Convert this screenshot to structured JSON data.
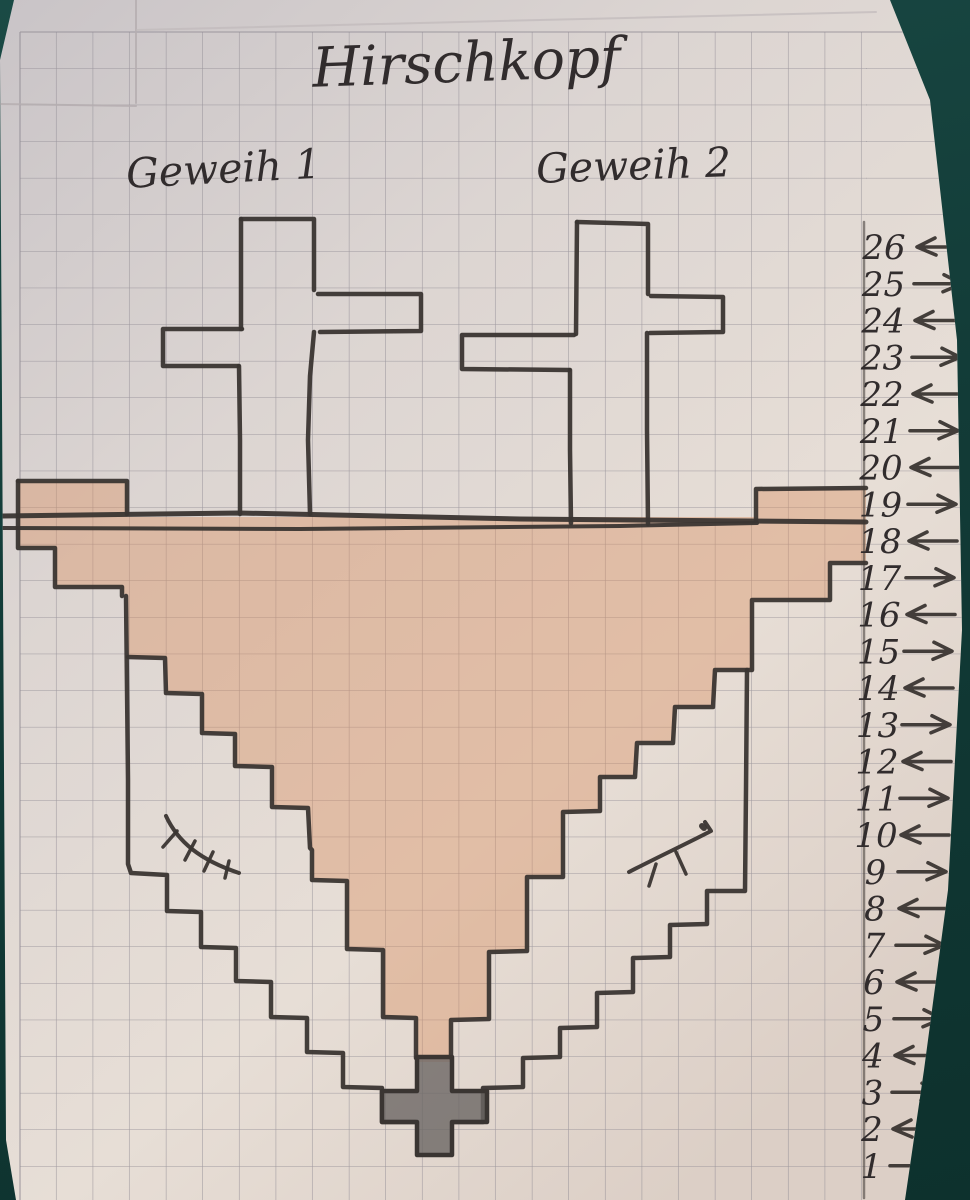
{
  "title": "Hirschkopf",
  "labels": {
    "antler1": "Geweih 1",
    "antler2": "Geweih 2"
  },
  "rows": [
    {
      "n": "26",
      "dir": "left"
    },
    {
      "n": "25",
      "dir": "right"
    },
    {
      "n": "24",
      "dir": "left"
    },
    {
      "n": "23",
      "dir": "right"
    },
    {
      "n": "22",
      "dir": "left"
    },
    {
      "n": "21",
      "dir": "right"
    },
    {
      "n": "20",
      "dir": "left"
    },
    {
      "n": "19",
      "dir": "right"
    },
    {
      "n": "18",
      "dir": "left"
    },
    {
      "n": "17",
      "dir": "right"
    },
    {
      "n": "16",
      "dir": "left"
    },
    {
      "n": "15",
      "dir": "right"
    },
    {
      "n": "14",
      "dir": "left"
    },
    {
      "n": "13",
      "dir": "right"
    },
    {
      "n": "12",
      "dir": "left"
    },
    {
      "n": "11",
      "dir": "right"
    },
    {
      "n": "10",
      "dir": "left"
    },
    {
      "n": "9",
      "dir": "right"
    },
    {
      "n": "8",
      "dir": "left"
    },
    {
      "n": "7",
      "dir": "right"
    },
    {
      "n": "6",
      "dir": "left"
    },
    {
      "n": "5",
      "dir": "right"
    },
    {
      "n": "4",
      "dir": "left"
    },
    {
      "n": "3",
      "dir": "right"
    },
    {
      "n": "2",
      "dir": "left"
    },
    {
      "n": "1",
      "dir": "right"
    }
  ],
  "colors": {
    "background": "#123b37",
    "paper_top": "#c9c4c7",
    "paper_mid": "#e2dad5",
    "paper_low": "#e7ded6",
    "paper_bottom": "#dccfc6",
    "grid": "#8f8a92",
    "pen": "#3a3532",
    "seam": "#b5aeb0",
    "head_fill": "#d98f60",
    "nose_fill": "#6b6764"
  },
  "drawing": {
    "head_fill_path": "M18,481 L127,481 L127,517 L756,517 L756,488 L866,488 L866,563 L830,563 L830,600 L752,600 L752,670 L715,670 L713,707 L675,707 L673,743 L637,743 L635,777 L600,777 L600,811 L563,812 L563,877 L527,877 L527,951 L489,952 L489,1019 L451,1020 L451,1062 L416,1062 L416,1018 L383,1017 L383,950 L347,949 L347,881 L312,880 L312,849 L308,848 L308,808 L272,807 L272,767 L235,766 L235,734 L202,733 L202,694 L166,693 L166,658 L128,657 L128,595 L122,593 L122,587 L55,587 L55,548 L18,548 Z",
    "nose_cross_path": "M417,1057 L452,1057 L452,1091 L487,1091 L487,1122 L452,1122 L452,1155 L417,1155 L417,1122 L382,1122 L382,1091 L417,1091 Z",
    "pen": [
      {
        "d": "M2,516 L240,513 L520,519 L866,522",
        "w": 5
      },
      {
        "d": "M2,528 L300,529 L620,526 L757,523",
        "w": 4
      },
      {
        "d": "M241,219 L314,219 L314,290",
        "w": 4.5
      },
      {
        "d": "M318,294 L421,294 L421,331 L320,332",
        "w": 4.5
      },
      {
        "d": "M314,332 L310,376 L308,440 L310,514",
        "w": 4.5
      },
      {
        "d": "M241,219 L241,329",
        "w": 4.5
      },
      {
        "d": "M242,329 L163,329 L163,366 L238,366",
        "w": 4.5
      },
      {
        "d": "M239,366 L240,440 L240,514",
        "w": 4.5
      },
      {
        "d": "M577,222 L648,224 L648,294",
        "w": 4.5
      },
      {
        "d": "M651,296 L723,297 L723,332 L650,333",
        "w": 4.5
      },
      {
        "d": "M647,333 L647,430 L648,524",
        "w": 4.5
      },
      {
        "d": "M577,222 L576,334",
        "w": 4.5
      },
      {
        "d": "M574,335 L462,335 L462,369 L569,370",
        "w": 4.5
      },
      {
        "d": "M570,370 L570,450 L571,523",
        "w": 4.5
      },
      {
        "d": "M18,481 L127,481 L127,514",
        "w": 4.5
      },
      {
        "d": "M18,481 L18,548 L55,548 L55,587 L122,587 L122,596",
        "w": 4.5
      },
      {
        "d": "M756,521 L756,489 L866,488",
        "w": 4.5
      },
      {
        "d": "M126,596 L128,780 L128,864 L131,873 L167,875 L167,911 L201,912 L201,947 L236,948 L236,981 L271,982 L271,1017 L307,1018 L307,1052 L343,1053 L343,1087 L382,1088 L382,1122 L415,1122",
        "w": 4.5
      },
      {
        "d": "M747,670 L746,790 L745,891 L707,891 L707,924 L670,925 L670,957 L633,958 L633,992 L597,993 L597,1027 L560,1028 L560,1057 L523,1058 L523,1087 L483,1088 L483,1122 L454,1122",
        "w": 4.5
      },
      {
        "d": "M866,563 L830,563 L830,600 L752,600 L752,670 L715,670 L713,707 L675,707 L673,743 L637,743 L635,777 L600,777 L600,811 L563,812 L563,877 L527,877 L527,951 L489,952 L489,1019 L451,1020 L451,1058",
        "w": 4.5
      },
      {
        "d": "M128,657 L165,658 L166,693 L202,694 L202,733 L235,734 L235,766 L272,767 L272,807 L308,808 L310,848 L312,850 L312,880 L347,881 L347,949 L383,950 L383,1017 L416,1018 L416,1058",
        "w": 4.5
      },
      {
        "d": "M166,816 C178,842 200,860 239,873",
        "w": 4
      },
      {
        "d": "M177,831 L163,847",
        "w": 3.5
      },
      {
        "d": "M195,841 L185,860",
        "w": 3.5
      },
      {
        "d": "M213,852 L204,871",
        "w": 3.5
      },
      {
        "d": "M229,861 L225,878",
        "w": 3.5
      },
      {
        "d": "M629,872 C658,857 688,843 711,831 L705,822",
        "w": 4
      },
      {
        "d": "M656,864 L649,886",
        "w": 3.5
      },
      {
        "d": "M676,852 L686,874",
        "w": 3.5
      },
      {
        "d": "M702,826 l2,2",
        "w": 6
      },
      {
        "d": "M864,222 L864,1198",
        "w": 2.5,
        "o": 0.55
      },
      {
        "d": "M136,0 L136,103",
        "c": "#b5aeb0",
        "w": 2,
        "o": 0.85
      },
      {
        "d": "M0,104 L136,106",
        "c": "#b5aeb0",
        "w": 2,
        "o": 0.85
      },
      {
        "d": "M137,30 L500,21 L876,12",
        "c": "#c0b9ba",
        "w": 2,
        "o": 0.7
      }
    ]
  }
}
